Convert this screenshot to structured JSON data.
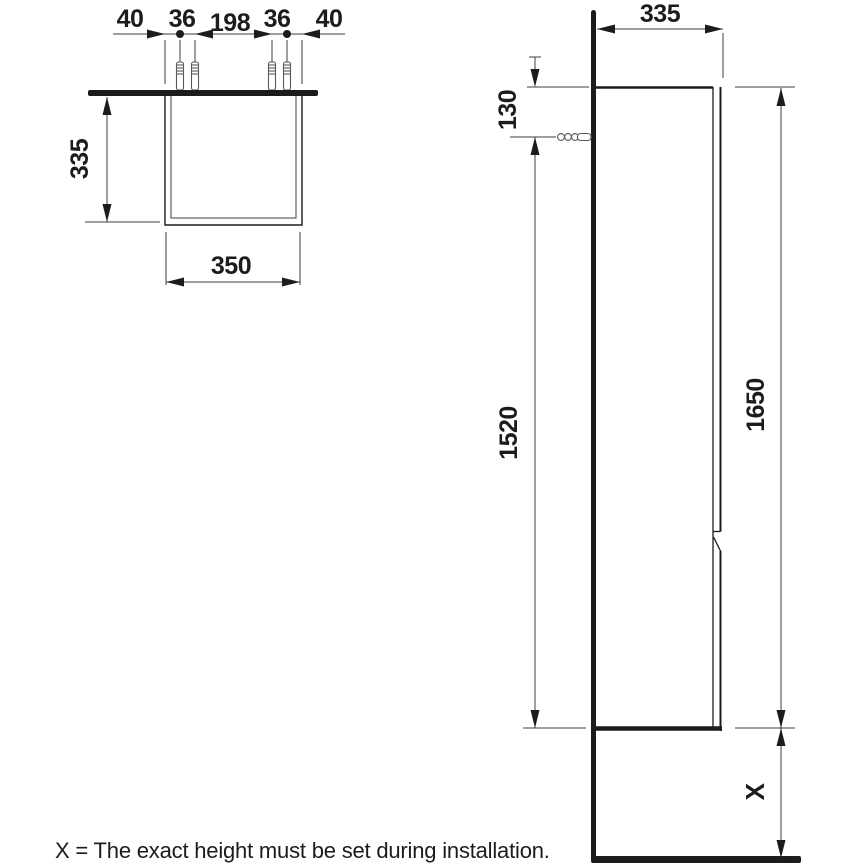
{
  "caption": "X = The exact height must be set during installation.",
  "colors": {
    "ink": "#1c1c1c",
    "thin_line": "#3f3f3f",
    "background": "#ffffff"
  },
  "plan_view": {
    "title": "top-view-of-cabinet",
    "dim_chain": {
      "left_margin": "40",
      "anchor_pair_left": "36",
      "anchor_span": "198",
      "anchor_pair_right": "36",
      "right_margin": "40"
    },
    "depth": "335",
    "width": "350",
    "anchor_count": 4
  },
  "elevation_view": {
    "title": "side-view-of-cabinet",
    "depth": "335",
    "anchor_offset_from_top": "130",
    "height_below_anchor": "1520",
    "total_height": "1650",
    "floor_clearance": "X"
  }
}
